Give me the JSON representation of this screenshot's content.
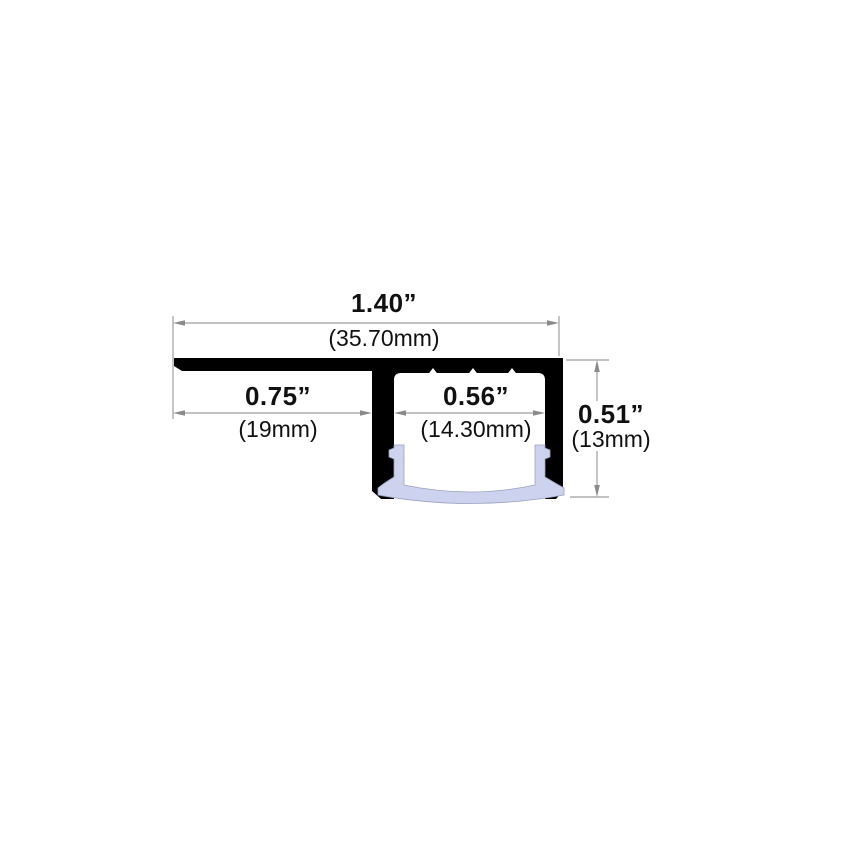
{
  "diagram": {
    "dimensions": {
      "overall_width": {
        "inches": "1.40”",
        "metric": "(35.70mm)"
      },
      "left_flange_width": {
        "inches": "0.75”",
        "metric": "(19mm)"
      },
      "channel_opening_width": {
        "inches": "0.56”",
        "metric": "(14.30mm)"
      },
      "overall_height": {
        "inches": "0.51”",
        "metric": "(13mm)"
      }
    },
    "colors": {
      "profile_body": "#000000",
      "diffuser_lens": "#cdd3ee",
      "lens_outline": "#9aa2bd",
      "dimension_lines": "#9e9e9e",
      "arrowheads": "#8a8a8a",
      "label_text": "#111111",
      "background": "#ffffff"
    }
  }
}
